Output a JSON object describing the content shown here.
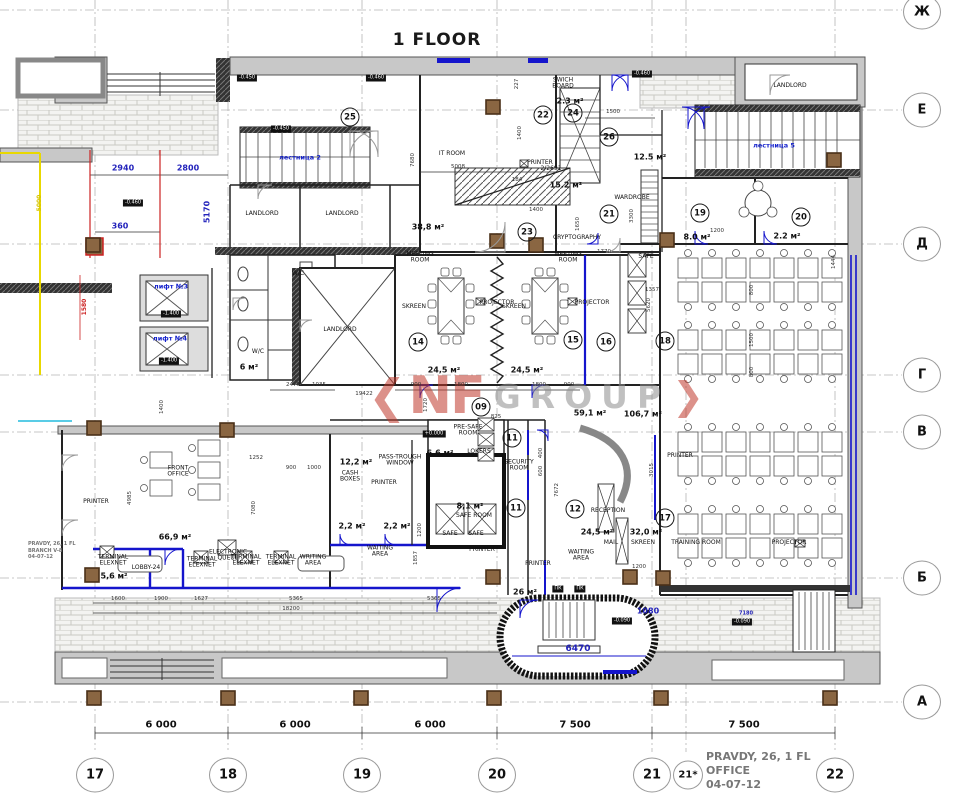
{
  "title": "1 FLOOR",
  "watermark": {
    "nf": "NF",
    "group": "GROUP"
  },
  "stamp_right": {
    "line1": "PRAVDY, 26, 1 FL",
    "line2": "OFFICE",
    "line3": "04-07-12"
  },
  "stamp_left": {
    "line1": "PRAVDY, 26, 1 FL",
    "line2": "BRANCH   V-8",
    "line3": "04-07-12"
  },
  "colors": {
    "dim_blue": "#2222bb",
    "wall_gray": "#c8c8c8",
    "new_wall_blue": "#1515cc",
    "accent_red": "#cc2222",
    "accent_yellow": "#d6c400",
    "watermark_red": "#c0392b"
  },
  "grid": {
    "rows": [
      {
        "label": "Ж",
        "y": 12
      },
      {
        "label": "Е",
        "y": 110
      },
      {
        "label": "Д",
        "y": 244
      },
      {
        "label": "Г",
        "y": 375
      },
      {
        "label": "В",
        "y": 432
      },
      {
        "label": "Б",
        "y": 578
      },
      {
        "label": "А",
        "y": 702
      }
    ],
    "cols": [
      {
        "label": "17",
        "x": 95
      },
      {
        "label": "18",
        "x": 228
      },
      {
        "label": "19",
        "x": 362
      },
      {
        "label": "20",
        "x": 497
      },
      {
        "label": "21",
        "x": 652
      },
      {
        "label": "21*",
        "x": 688,
        "sm": 1
      },
      {
        "label": "22",
        "x": 835
      }
    ]
  },
  "axis_dims": [
    {
      "t": "6 000",
      "x": 161,
      "y": 726
    },
    {
      "t": "6 000",
      "x": 295,
      "y": 726
    },
    {
      "t": "6 000",
      "x": 430,
      "y": 726
    },
    {
      "t": "7 500",
      "x": 575,
      "y": 726
    },
    {
      "t": "7 500",
      "x": 744,
      "y": 726
    }
  ],
  "room_circles": [
    {
      "n": "25",
      "x": 350,
      "y": 117
    },
    {
      "n": "22",
      "x": 543,
      "y": 115
    },
    {
      "n": "24",
      "x": 573,
      "y": 113
    },
    {
      "n": "26",
      "x": 609,
      "y": 137
    },
    {
      "n": "21",
      "x": 609,
      "y": 214
    },
    {
      "n": "19",
      "x": 700,
      "y": 213
    },
    {
      "n": "20",
      "x": 801,
      "y": 217
    },
    {
      "n": "23",
      "x": 527,
      "y": 232
    },
    {
      "n": "14",
      "x": 418,
      "y": 342
    },
    {
      "n": "15",
      "x": 573,
      "y": 340
    },
    {
      "n": "16",
      "x": 606,
      "y": 342
    },
    {
      "n": "18",
      "x": 665,
      "y": 341
    },
    {
      "n": "09",
      "x": 481,
      "y": 407
    },
    {
      "n": "11",
      "x": 512,
      "y": 438
    },
    {
      "n": "11",
      "x": 516,
      "y": 508
    },
    {
      "n": "12",
      "x": 575,
      "y": 509
    },
    {
      "n": "17",
      "x": 665,
      "y": 518
    }
  ],
  "labels": [
    {
      "t": "IT ROOM",
      "x": 452,
      "y": 154
    },
    {
      "t": "SWICH\nBOARD",
      "x": 563,
      "y": 84
    },
    {
      "t": "PRINTER",
      "x": 540,
      "y": 163
    },
    {
      "t": "2/2691",
      "x": 551,
      "y": 169
    },
    {
      "t": "CRYPTOGRAPHY",
      "x": 577,
      "y": 238
    },
    {
      "t": "WARDROBE",
      "x": 632,
      "y": 198
    },
    {
      "t": "MEETING\nROOM",
      "x": 420,
      "y": 258
    },
    {
      "t": "MEETING\nROOM",
      "x": 568,
      "y": 258
    },
    {
      "t": "SKREEN",
      "x": 414,
      "y": 307
    },
    {
      "t": "SKREEN",
      "x": 514,
      "y": 307
    },
    {
      "t": "PROJECTOR",
      "x": 497,
      "y": 303
    },
    {
      "t": "PROJECTOR",
      "x": 592,
      "y": 303
    },
    {
      "t": "LANDLORD",
      "x": 262,
      "y": 214
    },
    {
      "t": "LANDLORD",
      "x": 342,
      "y": 214
    },
    {
      "t": "LANDLORD",
      "x": 340,
      "y": 330
    },
    {
      "t": "LANDLORD",
      "x": 790,
      "y": 86
    },
    {
      "t": "W/C",
      "x": 298,
      "y": 274
    },
    {
      "t": "W/C",
      "x": 258,
      "y": 352
    },
    {
      "t": "SAFE",
      "x": 646,
      "y": 257
    },
    {
      "t": "FRONT\nOFFICE",
      "x": 178,
      "y": 472
    },
    {
      "t": "ELECTRONIC\nQUEUE",
      "x": 228,
      "y": 556
    },
    {
      "t": "TERMINAL\nELEXNET",
      "x": 113,
      "y": 561
    },
    {
      "t": "TERMINAL\nELEXNET",
      "x": 202,
      "y": 563
    },
    {
      "t": "TERMINAL\nELEXNET",
      "x": 246,
      "y": 561
    },
    {
      "t": "TERMINAL\nELEXNET",
      "x": 281,
      "y": 561
    },
    {
      "t": "LOBBY-24",
      "x": 146,
      "y": 568
    },
    {
      "t": "PRE-SAFE\nROOM",
      "x": 468,
      "y": 431
    },
    {
      "t": "LOKERS",
      "x": 479,
      "y": 452
    },
    {
      "t": "PASS-TROUGH\nWINDOW",
      "x": 400,
      "y": 461
    },
    {
      "t": "CASH\nBOXES",
      "x": 350,
      "y": 477
    },
    {
      "t": "PRINTER",
      "x": 384,
      "y": 483
    },
    {
      "t": "SAFE ROOM",
      "x": 474,
      "y": 516
    },
    {
      "t": "SAFE",
      "x": 450,
      "y": 534
    },
    {
      "t": "SAFE",
      "x": 476,
      "y": 534
    },
    {
      "t": "WAITING\nAREA",
      "x": 380,
      "y": 552
    },
    {
      "t": "WAITING\nAREA",
      "x": 581,
      "y": 556
    },
    {
      "t": "WRITING\nAREA",
      "x": 313,
      "y": 561
    },
    {
      "t": "SECURITY\nROOM",
      "x": 519,
      "y": 466
    },
    {
      "t": "RECEPTION",
      "x": 608,
      "y": 511
    },
    {
      "t": "MAIL",
      "x": 611,
      "y": 543
    },
    {
      "t": "SKREEN",
      "x": 643,
      "y": 543
    },
    {
      "t": "TRAINING ROOM",
      "x": 696,
      "y": 543
    },
    {
      "t": "PROJECTOR",
      "x": 789,
      "y": 543
    },
    {
      "t": "PRINTER",
      "x": 680,
      "y": 456
    },
    {
      "t": "PRINTER",
      "x": 96,
      "y": 502
    },
    {
      "t": "PRINTER",
      "x": 482,
      "y": 550
    },
    {
      "t": "PRINTER",
      "x": 538,
      "y": 564
    }
  ],
  "labels_blue": [
    {
      "t": "лестница 2",
      "x": 300,
      "y": 158
    },
    {
      "t": "лестница 5",
      "x": 774,
      "y": 146
    },
    {
      "t": "лифт №3",
      "x": 171,
      "y": 287
    },
    {
      "t": "лифт №4",
      "x": 170,
      "y": 339
    }
  ],
  "areas": [
    {
      "t": "2.3 м²",
      "x": 570,
      "y": 102
    },
    {
      "t": "12.5 м²",
      "x": 650,
      "y": 158
    },
    {
      "t": "15.2 м²",
      "x": 566,
      "y": 186
    },
    {
      "t": "38,8 м²",
      "x": 428,
      "y": 228
    },
    {
      "t": "8.0 м²",
      "x": 697,
      "y": 238
    },
    {
      "t": "2.2 м²",
      "x": 787,
      "y": 237
    },
    {
      "t": "24,5 м²",
      "x": 444,
      "y": 371
    },
    {
      "t": "24,5 м²",
      "x": 527,
      "y": 371
    },
    {
      "t": "59,1 м²",
      "x": 590,
      "y": 414
    },
    {
      "t": "106,7 м²",
      "x": 643,
      "y": 415
    },
    {
      "t": "6,6 м²",
      "x": 440,
      "y": 454
    },
    {
      "t": "12,2 м²",
      "x": 356,
      "y": 463
    },
    {
      "t": "8,1 м²",
      "x": 470,
      "y": 507
    },
    {
      "t": "2,2 м²",
      "x": 352,
      "y": 527
    },
    {
      "t": "2,2 м²",
      "x": 397,
      "y": 527
    },
    {
      "t": "66,9 м²",
      "x": 175,
      "y": 538
    },
    {
      "t": "5,6 м²",
      "x": 114,
      "y": 577
    },
    {
      "t": "24,5 м²",
      "x": 597,
      "y": 533
    },
    {
      "t": "32,0 м²",
      "x": 646,
      "y": 533
    },
    {
      "t": "26 м²",
      "x": 525,
      "y": 593
    },
    {
      "t": "6 м²",
      "x": 249,
      "y": 368
    }
  ],
  "dims_blue": [
    {
      "t": "2940",
      "x": 123,
      "y": 169
    },
    {
      "t": "2800",
      "x": 188,
      "y": 169
    },
    {
      "t": "360",
      "x": 120,
      "y": 227
    },
    {
      "t": "5170",
      "x": 208,
      "y": 212,
      "r": 1
    },
    {
      "t": "6470",
      "x": 578,
      "y": 650,
      "s": 9
    },
    {
      "t": "1080",
      "x": 648,
      "y": 612
    },
    {
      "t": "7180",
      "x": 746,
      "y": 614,
      "s": 5
    }
  ],
  "dims_black": [
    {
      "t": "5008",
      "x": 458,
      "y": 168
    },
    {
      "t": "7680",
      "x": 414,
      "y": 160,
      "r": 1
    },
    {
      "t": "227",
      "x": 518,
      "y": 84,
      "r": 1
    },
    {
      "t": "1400",
      "x": 521,
      "y": 133,
      "r": 1
    },
    {
      "t": "184",
      "x": 517,
      "y": 181
    },
    {
      "t": "1500",
      "x": 613,
      "y": 113
    },
    {
      "t": "1400",
      "x": 536,
      "y": 211
    },
    {
      "t": "1650",
      "x": 579,
      "y": 224,
      "r": 1
    },
    {
      "t": "1770",
      "x": 604,
      "y": 253
    },
    {
      "t": "3300",
      "x": 633,
      "y": 216,
      "r": 1
    },
    {
      "t": "5620",
      "x": 650,
      "y": 305,
      "r": 1
    },
    {
      "t": "1357",
      "x": 652,
      "y": 291
    },
    {
      "t": "1444",
      "x": 835,
      "y": 262,
      "r": 1
    },
    {
      "t": "800",
      "x": 753,
      "y": 290,
      "r": 1
    },
    {
      "t": "1500",
      "x": 753,
      "y": 340,
      "r": 1
    },
    {
      "t": "800",
      "x": 753,
      "y": 372,
      "r": 1
    },
    {
      "t": "3015",
      "x": 653,
      "y": 470,
      "r": 1
    },
    {
      "t": "1720",
      "x": 427,
      "y": 405,
      "r": 1
    },
    {
      "t": "19422",
      "x": 364,
      "y": 395
    },
    {
      "t": "900",
      "x": 416,
      "y": 386
    },
    {
      "t": "1800",
      "x": 461,
      "y": 386
    },
    {
      "t": "1800",
      "x": 539,
      "y": 386
    },
    {
      "t": "900",
      "x": 569,
      "y": 386
    },
    {
      "t": "825",
      "x": 496,
      "y": 418
    },
    {
      "t": "1252",
      "x": 256,
      "y": 459
    },
    {
      "t": "7080",
      "x": 255,
      "y": 508,
      "r": 1
    },
    {
      "t": "900",
      "x": 291,
      "y": 469
    },
    {
      "t": "1000",
      "x": 314,
      "y": 469
    },
    {
      "t": "4985",
      "x": 131,
      "y": 498,
      "r": 1
    },
    {
      "t": "1400",
      "x": 163,
      "y": 407,
      "r": 1
    },
    {
      "t": "2475",
      "x": 293,
      "y": 386
    },
    {
      "t": "1035",
      "x": 319,
      "y": 386
    },
    {
      "t": "1600",
      "x": 118,
      "y": 600
    },
    {
      "t": "1900",
      "x": 161,
      "y": 600
    },
    {
      "t": "1627",
      "x": 201,
      "y": 600
    },
    {
      "t": "5365",
      "x": 296,
      "y": 600
    },
    {
      "t": "18200",
      "x": 291,
      "y": 610
    },
    {
      "t": "5365",
      "x": 434,
      "y": 600
    },
    {
      "t": "1857",
      "x": 417,
      "y": 558,
      "r": 1
    },
    {
      "t": "1200",
      "x": 421,
      "y": 530,
      "r": 1
    },
    {
      "t": "1200",
      "x": 639,
      "y": 568
    },
    {
      "t": "1200",
      "x": 717,
      "y": 232
    },
    {
      "t": "7672",
      "x": 558,
      "y": 490,
      "r": 1
    },
    {
      "t": "400",
      "x": 542,
      "y": 453,
      "r": 1
    },
    {
      "t": "600",
      "x": 542,
      "y": 471,
      "r": 1
    }
  ],
  "dims_yellow": [
    {
      "t": "5000",
      "x": 40,
      "y": 203,
      "r": 1
    }
  ],
  "dims_red": [
    {
      "t": "1580",
      "x": 85,
      "y": 307,
      "r": 1
    }
  ],
  "levels": [
    {
      "t": "-0.450",
      "x": 247,
      "y": 78
    },
    {
      "t": "-0.450",
      "x": 281,
      "y": 129
    },
    {
      "t": "-0.460",
      "x": 376,
      "y": 78
    },
    {
      "t": "-0.460",
      "x": 642,
      "y": 74
    },
    {
      "t": "-0.460",
      "x": 133,
      "y": 203
    },
    {
      "t": "-1.400",
      "x": 171,
      "y": 314
    },
    {
      "t": "-1.400",
      "x": 169,
      "y": 361
    },
    {
      "t": "+0.000",
      "x": 434,
      "y": 434
    },
    {
      "t": "-0.090",
      "x": 622,
      "y": 621
    },
    {
      "t": "-0.090",
      "x": 742,
      "y": 622
    },
    {
      "t": "ПК",
      "x": 558,
      "y": 589
    },
    {
      "t": "ПК",
      "x": 580,
      "y": 589
    }
  ]
}
